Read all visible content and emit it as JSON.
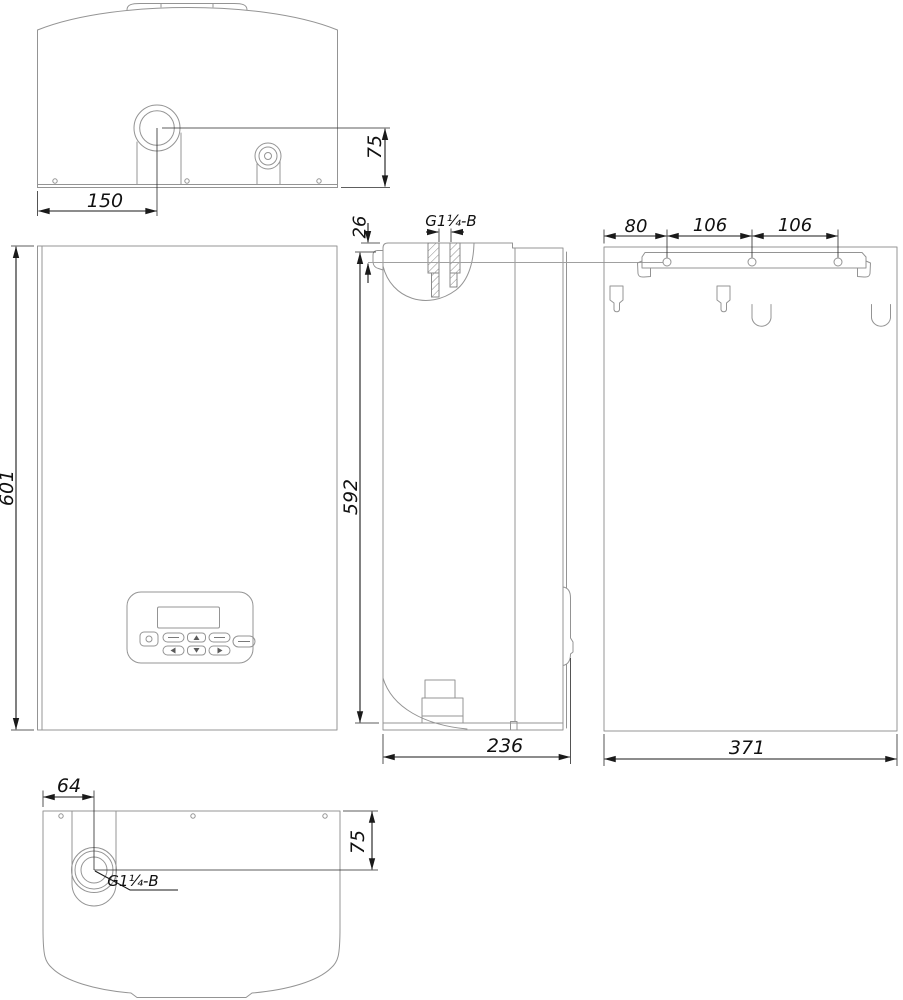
{
  "drawing": {
    "kind": "boiler-installation-dimension-drawing",
    "views": [
      "top",
      "front",
      "side",
      "back",
      "bottom"
    ]
  },
  "dims": {
    "top": {
      "pipe_offset_x": "150",
      "pipe_offset_y": "75"
    },
    "front": {
      "height": "601"
    },
    "side": {
      "top_inset": "26",
      "mount_height": "592",
      "depth": "236",
      "thread": "G1¼-B"
    },
    "back": {
      "hole_spacing": [
        "80",
        "106",
        "106"
      ],
      "width": "371"
    },
    "bottom": {
      "pipe_offset_x": "64",
      "pipe_offset_y": "75",
      "thread": "G1¼-B"
    }
  },
  "colors": {
    "outline": "#949494",
    "dimension": "#1a1a1a",
    "background": "#ffffff"
  }
}
